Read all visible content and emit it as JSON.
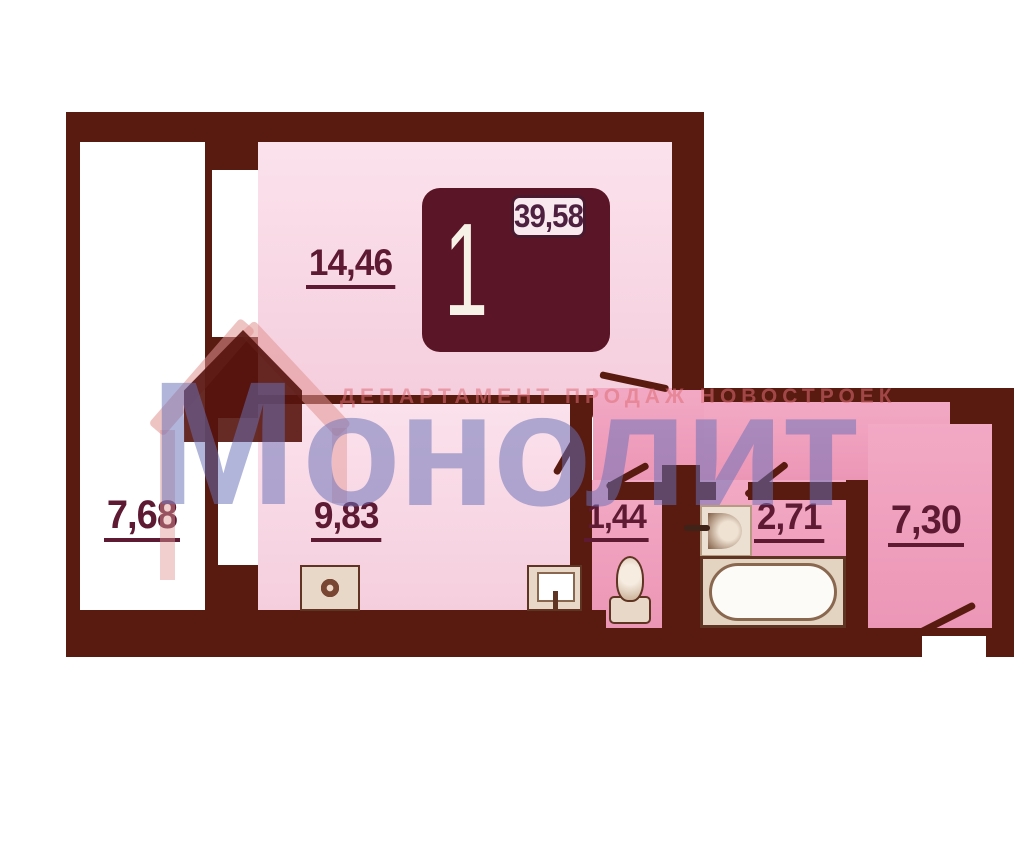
{
  "watermark": {
    "logo_first_letter": "М",
    "logo_rest": "онолит",
    "tagline": "ДЕПАРТАМЕНТ ПРОДАЖ НОВОСТРОЕК"
  },
  "unit_badge": {
    "rooms_count": "1",
    "living_area": "14,46",
    "total_area": "35,74",
    "full_area": "39,58"
  },
  "rooms": {
    "living": {
      "area": "14,46"
    },
    "balcony": {
      "area": "7,68"
    },
    "kitchen": {
      "area": "9,83"
    },
    "wc": {
      "area": "1,44"
    },
    "bathroom": {
      "area": "2,71"
    },
    "hallway": {
      "area": "7,30"
    }
  },
  "fixtures": [
    "stove-icon",
    "kitchen-sink-icon",
    "toilet-icon",
    "washbasin-icon",
    "bathtub-icon"
  ],
  "colors": {
    "wall": "#591a10",
    "room_light_pink": "#f7d5e2",
    "room_dark_pink": "#ef9fbc",
    "label": "#5e1a33",
    "badge_background": "#5a1527",
    "badge_cell": "#f7e9ee",
    "watermark_blue": "#6a72b8",
    "watermark_red": "#df6e76"
  }
}
